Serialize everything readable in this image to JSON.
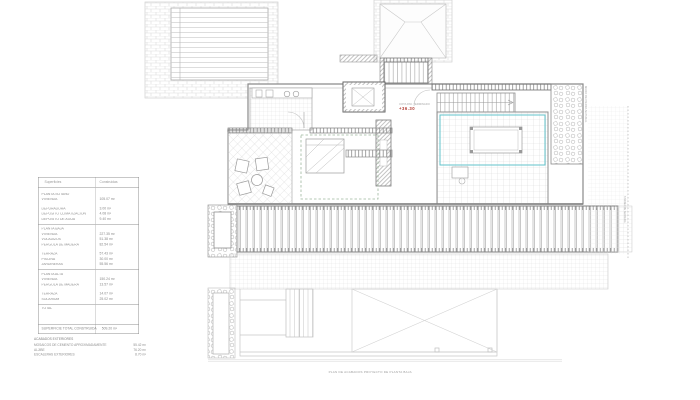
{
  "document": {
    "caption": "PLAN DE ACABADOS PROYECTO DE PLANTA BAJA",
    "elevation_marker": {
      "label": "COTA PAV. TERMINADO",
      "value": "+36.30"
    },
    "annotations": {
      "stone_wall": "MURO DE PIEDRA NATURAL",
      "deck": "TARIMA DE MADERA"
    }
  },
  "area_table": {
    "header": {
      "label": "Superficies",
      "value": "Construidas"
    },
    "rows": [
      {
        "type": "section",
        "label": "PLANTA SÓTANO",
        "value": ""
      },
      {
        "type": "item",
        "label": "VIVIENDA",
        "value": "105.07 m²"
      },
      {
        "type": "gap",
        "label": "",
        "value": ""
      },
      {
        "type": "item",
        "label": "DEPURADORA",
        "value": "3.00 m²"
      },
      {
        "type": "item",
        "label": "DEPÓSITO CLIMATIZACIÓN",
        "value": "4.08 m²"
      },
      {
        "type": "item",
        "label": "DEPÓSITO DE AGUA",
        "value": "9.40 m²"
      },
      {
        "type": "rule",
        "label": "",
        "value": ""
      },
      {
        "type": "section",
        "label": "PLANTA BAJA",
        "value": ""
      },
      {
        "type": "item",
        "label": "VIVIENDA",
        "value": "227.35 m²"
      },
      {
        "type": "item",
        "label": "VOLADIZOS",
        "value": "51.38 m²"
      },
      {
        "type": "item",
        "label": "PÉRGOLA DE MADERA",
        "value": "82.54 m²"
      },
      {
        "type": "gap",
        "label": "",
        "value": ""
      },
      {
        "type": "item",
        "label": "TERRAZA",
        "value": "57.43 m²"
      },
      {
        "type": "item",
        "label": "PISCINA",
        "value": "30.00 m²"
      },
      {
        "type": "item",
        "label": "JARDINERAS",
        "value": "55.56 m²"
      },
      {
        "type": "rule",
        "label": "",
        "value": ""
      },
      {
        "type": "section",
        "label": "PLANTA ALTA",
        "value": ""
      },
      {
        "type": "item",
        "label": "VIVIENDA",
        "value": "150.24 m²"
      },
      {
        "type": "item",
        "label": "PÉRGOLA DE MADERA",
        "value": "13.57 m²"
      },
      {
        "type": "gap",
        "label": "",
        "value": ""
      },
      {
        "type": "item",
        "label": "TERRAZA",
        "value": "14.07 m²"
      },
      {
        "type": "item",
        "label": "SOLARIUM",
        "value": "25.02 m²"
      },
      {
        "type": "rule",
        "label": "",
        "value": ""
      },
      {
        "type": "item",
        "label": "TOTAL",
        "value": ""
      }
    ],
    "total": {
      "label": "SUPERFICIE TOTAL CONSTRUIDA",
      "value": "509.20 m²"
    }
  },
  "exterior_notes": {
    "title": "ACABADOS EXTERIORES",
    "items": [
      {
        "label": "MOSAICOS DE CEMENTO APROXIMADAMENTE",
        "value": "55.42 m²"
      },
      {
        "label": "ALJIBE",
        "value": "76.20 m²"
      },
      {
        "label": "ESCALERAS EXTERIORES",
        "value": "8.70 m²"
      }
    ]
  },
  "colors": {
    "accent_teal": "#62c3cb",
    "marker_red": "#b23b32",
    "dashed_green": "#9db79d",
    "line_gray": "#8f8f8f"
  }
}
